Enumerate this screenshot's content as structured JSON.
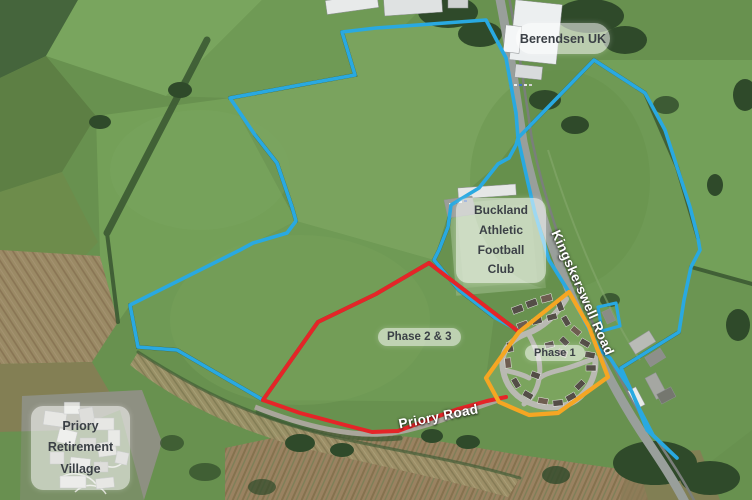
{
  "map": {
    "labels": {
      "berendsen": "Berendsen UK",
      "buckland_lines": [
        "Buckland",
        "Athletic Football",
        "Club"
      ],
      "phase23": "Phase 2 & 3",
      "phase1": "Phase 1",
      "priory_village_lines": [
        "Priory",
        "Retirement",
        "Village"
      ],
      "kingskerswell_road": "Kingskerswell Road",
      "priory_road": "Priory Road"
    },
    "colors": {
      "site_boundary": "#29a9e1",
      "phase23_boundary": "#e52528",
      "phase1_boundary": "#f5a623"
    }
  }
}
